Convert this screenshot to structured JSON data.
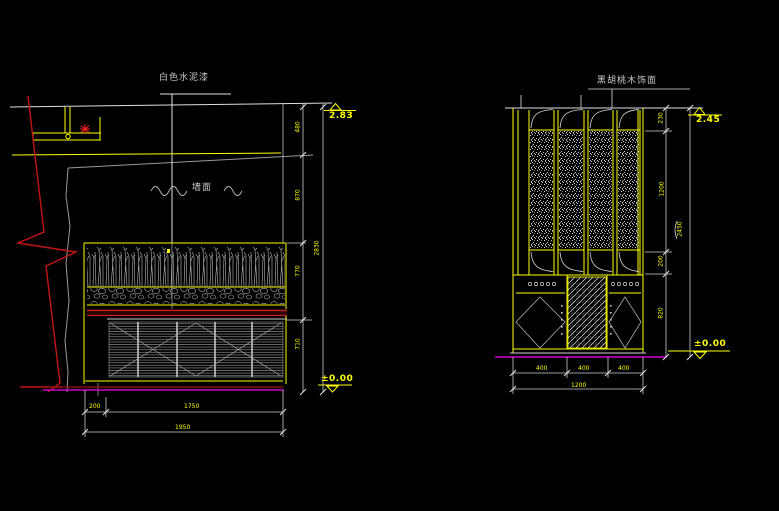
{
  "palette": {
    "background": "#000000",
    "line_white": "#e0e0e0",
    "line_yellow": "#ffff00",
    "line_red": "#c41414",
    "line_magenta": "#cc00cc",
    "hatch_grey": "#b0b0b0"
  },
  "left_view": {
    "finish_label": "白色水泥漆",
    "wall_note": "墙面",
    "elevation_top": "2.83",
    "elevation_zero": "±0.00",
    "dim_v1": "480",
    "dim_v2": "870",
    "dim_v3": "770",
    "dim_v4": "710",
    "dim_v_total": "2830",
    "dim_b1": "200",
    "dim_b2": "1750",
    "dim_b_total": "1950"
  },
  "right_view": {
    "finish_label": "黑胡桃木饰面",
    "elevation_top": "2.45",
    "elevation_zero": "±0.00",
    "dim_v1": "230",
    "dim_v2": "1200",
    "dim_v3": "200",
    "dim_v4": "820",
    "dim_v_total": "2450",
    "dim_b1": "400",
    "dim_b2": "400",
    "dim_b3": "400",
    "dim_b_total": "1200"
  }
}
